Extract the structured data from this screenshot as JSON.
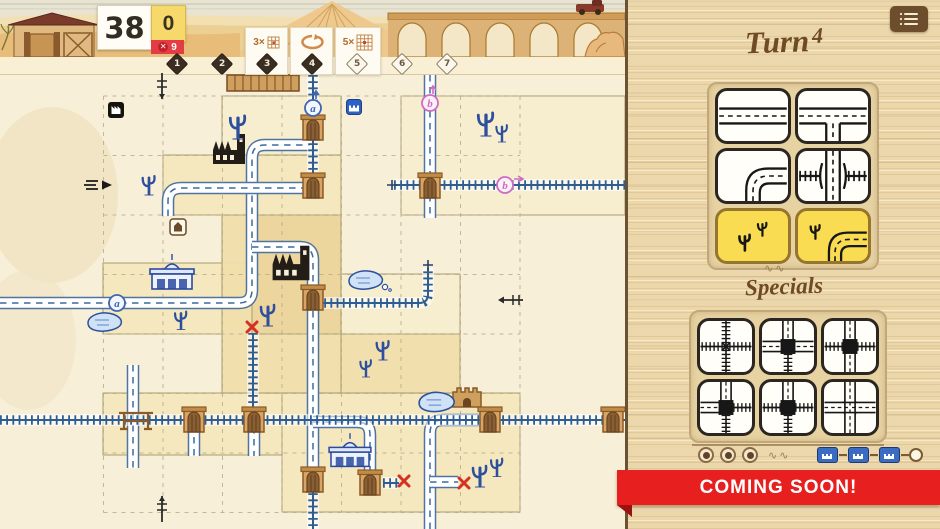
{
  "hud": {
    "score": "38",
    "bonus": "0",
    "penalty_count": "9",
    "penalty_icon": "x-circle",
    "turn_track": [
      {
        "n": "1",
        "filled": true
      },
      {
        "n": "2",
        "filled": true
      },
      {
        "n": "3",
        "filled": true
      },
      {
        "n": "4",
        "filled": true
      },
      {
        "n": "5",
        "filled": false
      },
      {
        "n": "6",
        "filled": false
      },
      {
        "n": "7",
        "filled": false
      }
    ],
    "turn_cards": [
      {
        "label": "3×",
        "icon": "grid-small",
        "x": 245,
        "w": 43
      },
      {
        "label": "",
        "icon": "undo-loop",
        "x": 290,
        "w": 43
      },
      {
        "label": "5×",
        "icon": "grid-big",
        "x": 335,
        "w": 46
      }
    ]
  },
  "panel": {
    "menu_icon": "list-menu",
    "turn_label": "Turn",
    "turn_number": "4",
    "specials_label": "Specials",
    "coming_soon": "COMING SOON!",
    "dice": [
      {
        "face": "road-straight",
        "color": "white"
      },
      {
        "face": "road-t",
        "color": "white"
      },
      {
        "face": "road-curve",
        "color": "white"
      },
      {
        "face": "overpass",
        "color": "white"
      },
      {
        "face": "desert",
        "color": "yellow"
      },
      {
        "face": "desert-curve",
        "color": "yellow"
      }
    ],
    "specials": [
      {
        "edges": {
          "top": "rail",
          "right": "rail",
          "bottom": "rail",
          "left": "rail"
        },
        "center": "cross"
      },
      {
        "edges": {
          "top": "road",
          "right": "road",
          "bottom": "rail",
          "left": "road"
        },
        "center": "square"
      },
      {
        "edges": {
          "top": "road",
          "right": "rail",
          "bottom": "road",
          "left": "rail"
        },
        "center": "square"
      },
      {
        "edges": {
          "top": "road",
          "right": "rail",
          "bottom": "rail",
          "left": "road"
        },
        "center": "square"
      },
      {
        "edges": {
          "top": "road",
          "right": "rail",
          "bottom": "rail",
          "left": "rail"
        },
        "center": "square"
      },
      {
        "edges": {
          "top": "road",
          "right": "road",
          "bottom": "road",
          "left": "road"
        },
        "center": "cross-road"
      }
    ],
    "tokens_used": 3,
    "station_chain": 3
  },
  "colors": {
    "road_ink": "#4f74a0",
    "rail_ink": "#2e5d94",
    "cactus_ink": "#2d4f9e",
    "yellow_tile": "#f9dc52",
    "ribbon_red": "#e71f1f",
    "wood": "#ecd7ab",
    "diamond_filled": "#3a2e22",
    "portal_blue": "#3f66b0",
    "portal_pink": "#cd6cc0"
  },
  "board": {
    "grid": {
      "x0": 103.5,
      "y0": 96,
      "cols": 7,
      "rows": 7,
      "cell": 59.5
    },
    "regions": [
      {
        "x": 163,
        "y": 155,
        "w": 178,
        "h": 60,
        "tone": "mid"
      },
      {
        "x": 222,
        "y": 96,
        "w": 119,
        "h": 59,
        "tone": "light"
      },
      {
        "x": 401,
        "y": 96,
        "w": 224,
        "h": 119,
        "tone": "light"
      },
      {
        "x": 103,
        "y": 263,
        "w": 179,
        "h": 71,
        "tone": "mid"
      },
      {
        "x": 222,
        "y": 215,
        "w": 119,
        "h": 178,
        "tone": "mid2"
      },
      {
        "x": 252,
        "y": 215,
        "w": 89,
        "h": 119,
        "tone": "dark"
      },
      {
        "x": 341,
        "y": 274,
        "w": 119,
        "h": 60,
        "tone": "light"
      },
      {
        "x": 341,
        "y": 334,
        "w": 119,
        "h": 59,
        "tone": "mid2"
      },
      {
        "x": 103,
        "y": 393,
        "w": 179,
        "h": 62,
        "tone": "mid"
      },
      {
        "x": 282,
        "y": 393,
        "w": 238,
        "h": 119,
        "tone": "mid"
      }
    ],
    "roads": [
      {
        "pts": [
          [
            0,
            303
          ],
          [
            252,
            303
          ],
          [
            252,
            145
          ],
          [
            310,
            145
          ]
        ]
      },
      {
        "pts": [
          [
            252,
            247
          ],
          [
            313,
            247
          ],
          [
            313,
            480
          ]
        ]
      },
      {
        "pts": [
          [
            168,
            216
          ],
          [
            168,
            188
          ],
          [
            310,
            188
          ]
        ]
      },
      {
        "pts": [
          [
            430,
            75
          ],
          [
            430,
            218
          ]
        ]
      },
      {
        "pts": [
          [
            133,
            365
          ],
          [
            133,
            468
          ]
        ]
      },
      {
        "pts": [
          [
            194,
            413
          ],
          [
            194,
            456
          ]
        ]
      },
      {
        "pts": [
          [
            254,
            427
          ],
          [
            254,
            456
          ]
        ]
      },
      {
        "pts": [
          [
            313,
            422
          ],
          [
            370,
            422
          ],
          [
            370,
            480
          ]
        ]
      },
      {
        "pts": [
          [
            430,
            529
          ],
          [
            430,
            420
          ],
          [
            489,
            420
          ]
        ]
      },
      {
        "pts": [
          [
            430,
            482
          ],
          [
            458,
            482
          ]
        ]
      }
    ],
    "rails": [
      {
        "pts": [
          [
            394,
            185
          ],
          [
            625,
            185
          ]
        ]
      },
      {
        "pts": [
          [
            0,
            420
          ],
          [
            625,
            420
          ]
        ]
      },
      {
        "pts": [
          [
            318,
            303
          ],
          [
            428,
            303
          ],
          [
            428,
            268
          ]
        ]
      },
      {
        "pts": [
          [
            253,
            333
          ],
          [
            253,
            413
          ]
        ]
      },
      {
        "pts": [
          [
            313,
            75
          ],
          [
            313,
            182
          ]
        ]
      },
      {
        "pts": [
          [
            313,
            487
          ],
          [
            313,
            529
          ]
        ]
      },
      {
        "pts": [
          [
            383,
            483
          ],
          [
            399,
            483
          ]
        ]
      }
    ],
    "icons": [
      {
        "t": "factory",
        "x": 229,
        "y": 156,
        "s": 1
      },
      {
        "t": "factory",
        "x": 291,
        "y": 271,
        "s": 1.15
      },
      {
        "t": "station",
        "x": 172,
        "y": 277,
        "s": 1
      },
      {
        "t": "station",
        "x": 350,
        "y": 455,
        "s": 0.95
      },
      {
        "t": "fort",
        "x": 467,
        "y": 397,
        "s": 1
      },
      {
        "t": "shack",
        "x": 263,
        "y": 83,
        "s": 1
      },
      {
        "t": "badge-factory",
        "x": 116,
        "y": 110
      },
      {
        "t": "badge-station",
        "x": 354,
        "y": 107
      },
      {
        "t": "badge-house",
        "x": 178,
        "y": 227
      },
      {
        "t": "pond",
        "x": 105,
        "y": 323,
        "s": 1
      },
      {
        "t": "pond-bubble",
        "x": 366,
        "y": 281,
        "s": 1
      },
      {
        "t": "pond",
        "x": 437,
        "y": 403,
        "s": 1.05
      },
      {
        "t": "cactus",
        "x": 238,
        "y": 128,
        "s": 1.1
      },
      {
        "t": "cactus",
        "x": 149,
        "y": 186,
        "s": 0.9
      },
      {
        "t": "cactus",
        "x": 486,
        "y": 125,
        "s": 1.1
      },
      {
        "t": "cactus",
        "x": 502,
        "y": 134,
        "s": 0.8
      },
      {
        "t": "cactus",
        "x": 268,
        "y": 316,
        "s": 1
      },
      {
        "t": "cactus",
        "x": 181,
        "y": 321,
        "s": 0.85
      },
      {
        "t": "cactus",
        "x": 383,
        "y": 351,
        "s": 0.9
      },
      {
        "t": "cactus",
        "x": 366,
        "y": 369,
        "s": 0.8
      },
      {
        "t": "cactus",
        "x": 480,
        "y": 477,
        "s": 1
      },
      {
        "t": "cactus",
        "x": 497,
        "y": 468,
        "s": 0.85
      },
      {
        "t": "bridge",
        "x": 136,
        "y": 420
      },
      {
        "t": "gate",
        "x": 313,
        "y": 128
      },
      {
        "t": "gate",
        "x": 313,
        "y": 186
      },
      {
        "t": "gate",
        "x": 430,
        "y": 186
      },
      {
        "t": "gate",
        "x": 313,
        "y": 298
      },
      {
        "t": "gate",
        "x": 194,
        "y": 420
      },
      {
        "t": "gate",
        "x": 254,
        "y": 420
      },
      {
        "t": "gate",
        "x": 490,
        "y": 420
      },
      {
        "t": "gate",
        "x": 613,
        "y": 420
      },
      {
        "t": "gate",
        "x": 313,
        "y": 480
      },
      {
        "t": "gate",
        "x": 370,
        "y": 483
      },
      {
        "t": "xmark",
        "x": 252,
        "y": 327
      },
      {
        "t": "xmark",
        "x": 404,
        "y": 481
      },
      {
        "t": "xmark",
        "x": 464,
        "y": 483
      },
      {
        "t": "exit-cross",
        "x": 162,
        "y": 86,
        "dir": "down"
      },
      {
        "t": "exit-cross",
        "x": 162,
        "y": 509,
        "dir": "up"
      },
      {
        "t": "exit-cross-h",
        "x": 511,
        "y": 300
      },
      {
        "t": "plus",
        "x": 392,
        "y": 185
      },
      {
        "t": "plus",
        "x": 428,
        "y": 265
      },
      {
        "t": "road-exit",
        "x": 100,
        "y": 185
      }
    ],
    "markers": [
      {
        "label": "a",
        "c": "blue",
        "x": 313,
        "y": 108,
        "arrow": "up"
      },
      {
        "label": "a",
        "c": "blue",
        "x": 117,
        "y": 303,
        "arrow": "none"
      },
      {
        "label": "b",
        "c": "pink",
        "x": 430,
        "y": 103,
        "arrow": "up"
      },
      {
        "label": "b",
        "c": "pink",
        "x": 505,
        "y": 185,
        "arrow": "right"
      }
    ]
  }
}
